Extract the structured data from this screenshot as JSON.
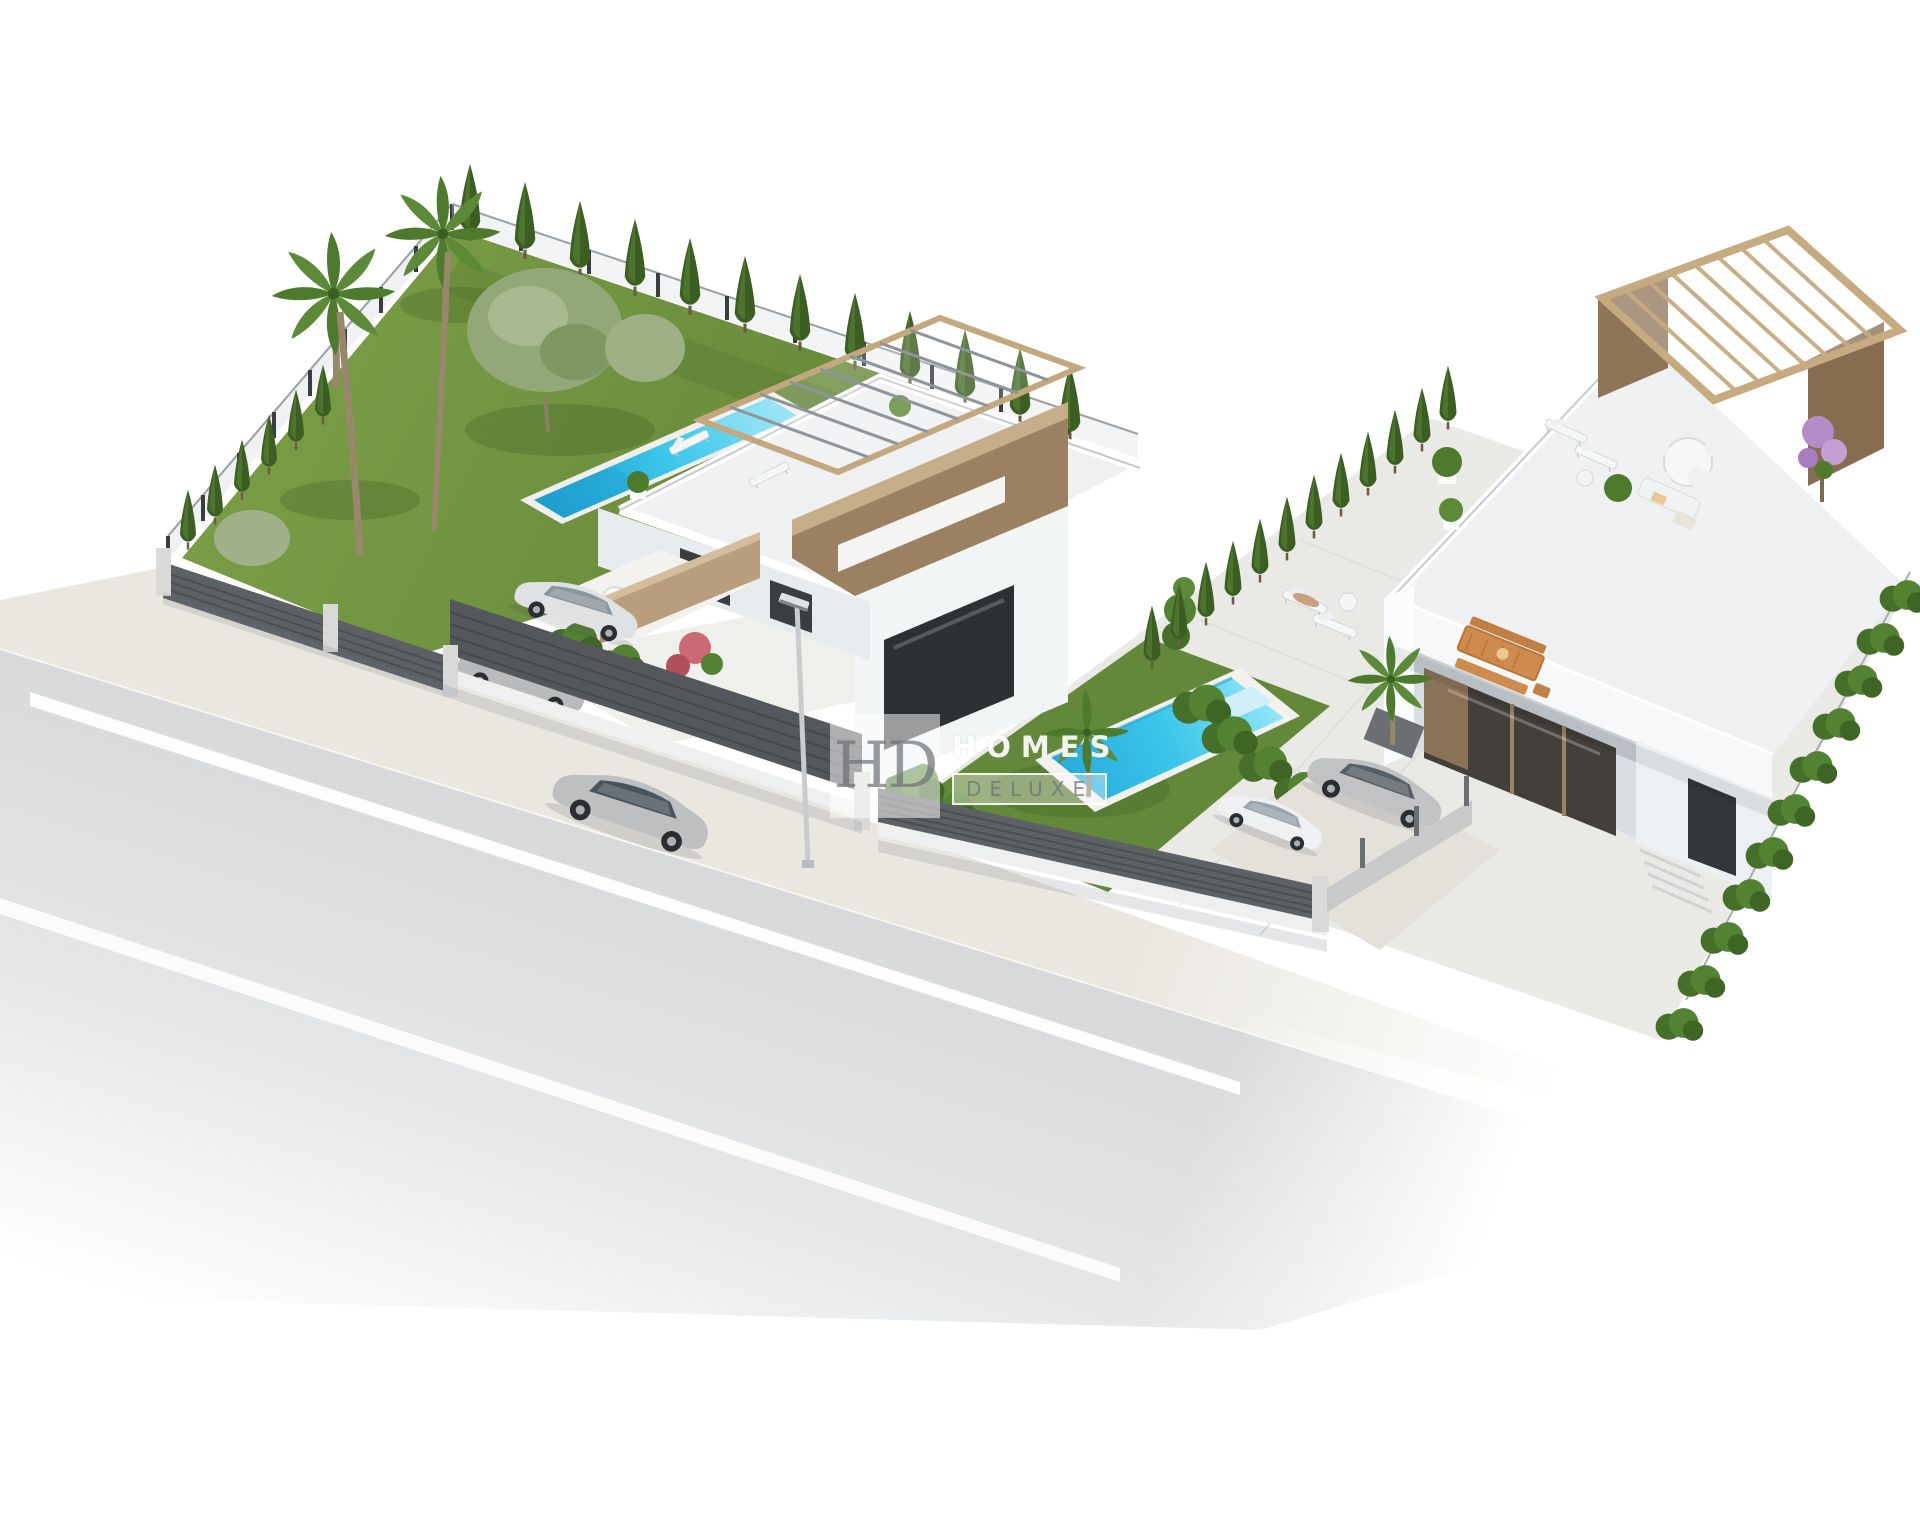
{
  "watermark": {
    "monogram": "HD",
    "title": "HOMES",
    "subtitle": "DELUXE"
  },
  "colors": {
    "background": "#ffffff",
    "road": "#d6d8d9",
    "road_marking": "#ffffff",
    "sidewalk": "#eae7e0",
    "grass": "#72943f",
    "grass_dark": "#5e7f33",
    "cypress_green": "#3c5e22",
    "shrub_green": "#4e7a2e",
    "olive_green": "#93a878",
    "pool_water": "#3cc6ea",
    "pool_deep": "#1f9fd0",
    "pool_coping": "#f2f1ee",
    "fence_dark": "#5c6165",
    "fence_pillar": "#d9dad8",
    "wall_white": "#f4f6f7",
    "wall_shade": "#dfe3e7",
    "wall_brown": "#9b8061",
    "pergola_wood": "#c3a87e",
    "beam_gray": "#8e9499",
    "window_dark": "#2e3133",
    "car_silver": "#c0c2c4",
    "car_white": "#eef0f2",
    "outdoor_wood": "#cf8a4e",
    "bougainvillea": "#b48cc8"
  },
  "scene": {
    "description": "Aerial 3D render of two modern white villas with private pools, gardens, fences and a street with a driving car",
    "objects": [
      "road",
      "sidewalk",
      "road-markings",
      "street-lamp",
      "driving-car",
      "left-villa",
      "left-roof-terrace",
      "tower-pergola",
      "left-lap-pool",
      "left-lawn",
      "palm-trees",
      "olive-tree",
      "cypress-hedges",
      "carport-cars",
      "privacy-fence",
      "right-villa",
      "right-roof-terrace",
      "wood-pergola",
      "right-pool",
      "right-lawn",
      "sun-loungers",
      "outdoor-dining-set",
      "roof-lounge-set",
      "parked-cars",
      "driveway",
      "boundary-hedge",
      "watermark"
    ]
  }
}
